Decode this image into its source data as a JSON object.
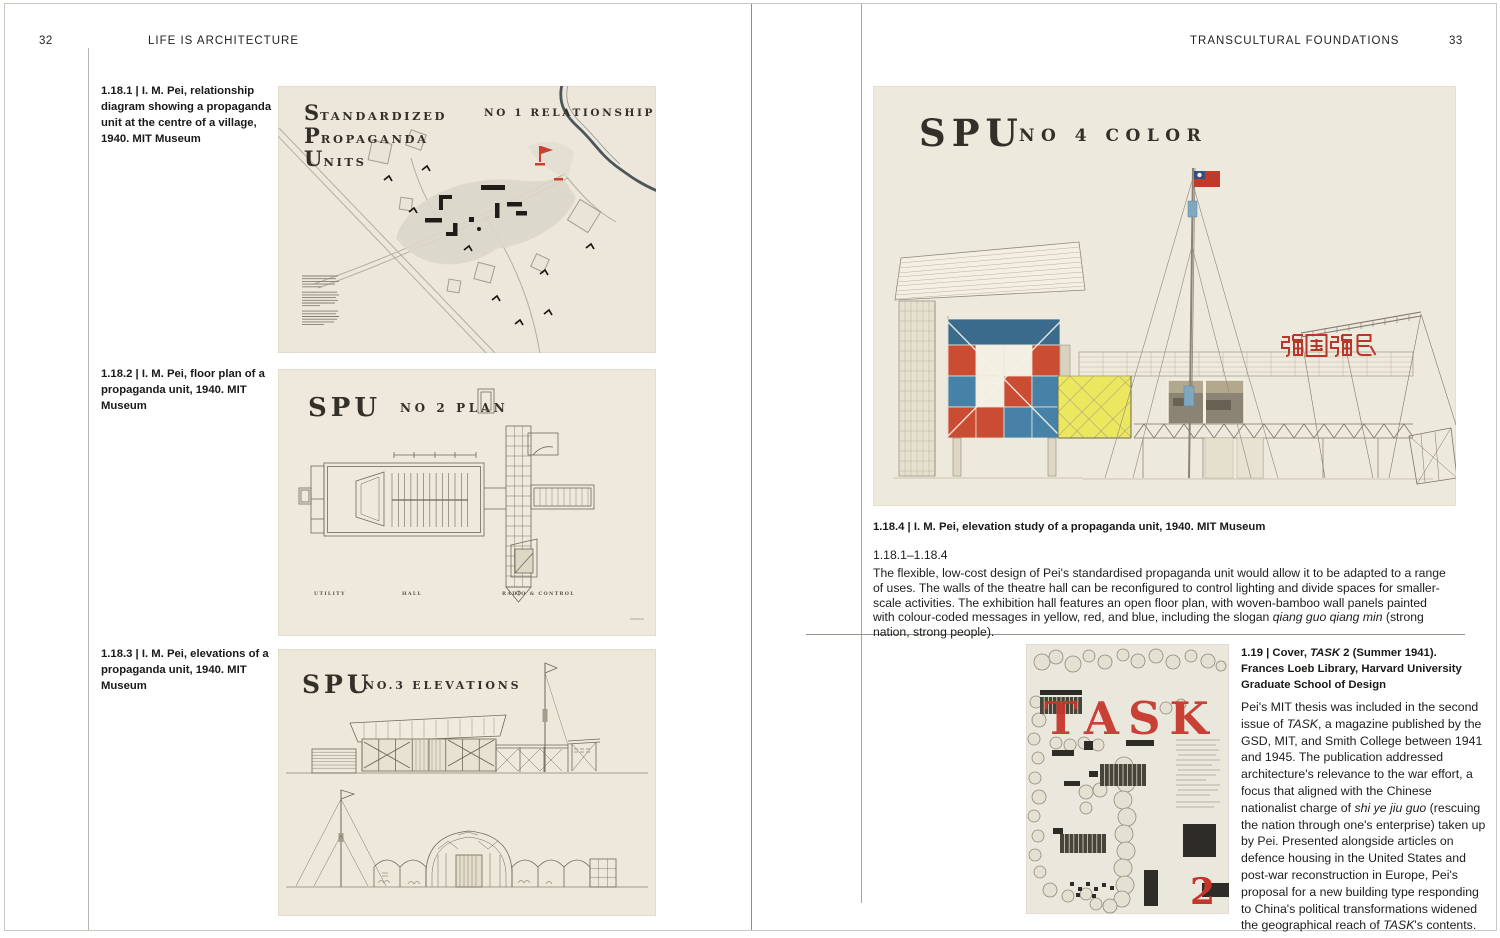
{
  "book": {
    "left": {
      "page_number": "32",
      "header": "LIFE IS ARCHITECTURE",
      "captions": [
        "1.18.1 | I. M. Pei, relationship diagram showing a propaganda unit at the centre of a village, 1940. MIT Museum",
        "1.18.2 | I. M. Pei, floor plan of a propaganda unit, 1940. MIT Museum",
        "1.18.3 | I. M. Pei, elevations of a propaganda unit, 1940. MIT Museum"
      ],
      "fig1": {
        "title": [
          {
            "initial": "S",
            "rest": "TANDARDIZED"
          },
          {
            "initial": "P",
            "rest": "ROPAGANDA"
          },
          {
            "initial": "U",
            "rest": "NITS"
          }
        ],
        "title_right": "NO 1 RELATIONSHIP"
      },
      "fig2": {
        "title": "SPU",
        "subtitle": "NO 2 PLAN",
        "labels": [
          "UTILITY",
          "HALL",
          "RADIO & CONTROL"
        ]
      },
      "fig3": {
        "title": "SPU",
        "subtitle": "NO.3  ELEVATIONS"
      }
    },
    "right": {
      "page_number": "33",
      "header": "TRANSCULTURAL FOUNDATIONS",
      "fig4": {
        "title": "SPU",
        "subtitle": "NO 4  COLOR",
        "slogan": "强國强民"
      },
      "caption4": "1.18.4 | I. M. Pei, elevation study of a propaganda unit, 1940. MIT Museum",
      "section_label": "1.18.1–1.18.4",
      "section_paragraph": [
        {
          "t": "The flexible, low-cost design of Pei's standardised propaganda unit would allow it to be adapted to a range of uses. The walls of the theatre hall can be reconfigured to control lighting and divide spaces for smaller-scale activities. The exhibition hall features an open floor plan, with woven-bamboo wall panels painted with colour-coded messages in yellow, red, and blue, including the slogan "
        },
        {
          "t": "qiang guo qiang min",
          "i": true
        },
        {
          "t": " (strong nation, strong people)."
        }
      ],
      "task_caption": [
        {
          "t": "1.19 | Cover, "
        },
        {
          "t": "TASK",
          "i": true
        },
        {
          "t": " 2 (Summer 1941). Frances Loeb Library, Harvard University Graduate School of Design"
        }
      ],
      "task_paragraph": [
        {
          "t": "Pei's MIT thesis was included in the second issue of "
        },
        {
          "t": "TASK",
          "i": true
        },
        {
          "t": ", a magazine published by the GSD, MIT, and Smith College between 1941 and 1945. The publication addressed architecture's relevance to the war effort, a focus that aligned with the Chinese nationalist charge of "
        },
        {
          "t": "shi ye jiu guo",
          "i": true
        },
        {
          "t": " (rescuing the nation through one's enterprise) taken up by Pei. Presented alongside articles on defence housing in the United States and post-war reconstruction in Europe, Pei's proposal for a new building type responding to China's political transformations widened the geographical reach of "
        },
        {
          "t": "TASK",
          "i": true
        },
        {
          "t": "'s contents."
        }
      ],
      "cover": {
        "title": "TASK",
        "issue": "2"
      }
    },
    "colors": {
      "paper_cream": "#ece7da",
      "ink": "#33302a",
      "accent_red": "#c8402e",
      "panel_blue": "#4682a8",
      "panel_dark_blue": "#3a6a8c",
      "panel_yellow": "#ece960",
      "task_red": "#c7352a"
    }
  }
}
